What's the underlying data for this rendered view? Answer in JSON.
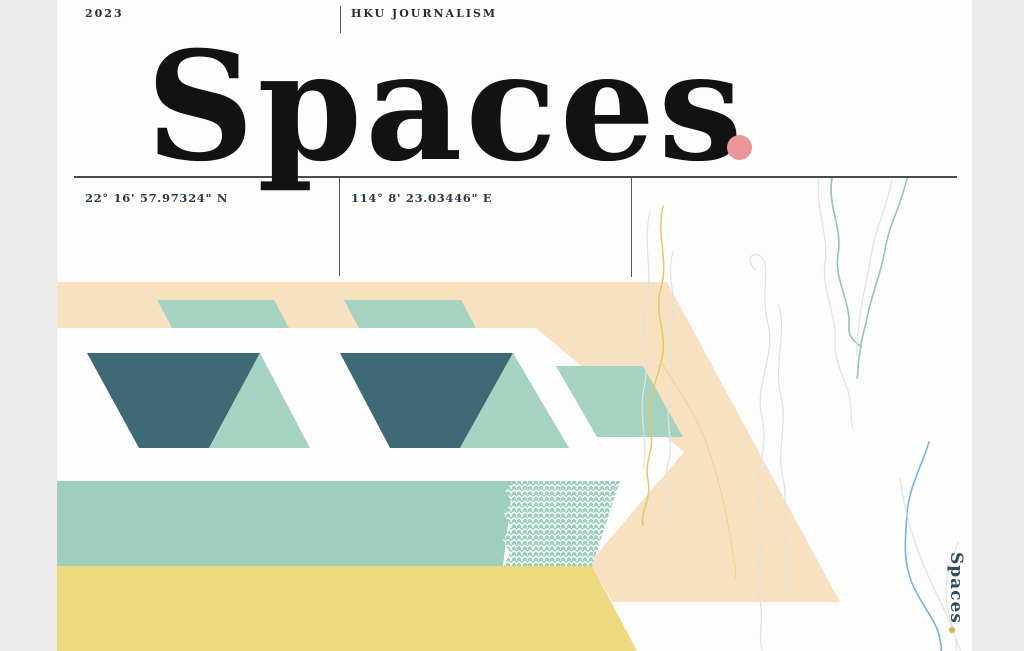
{
  "header": {
    "year": "2023",
    "org": "HKU JOURNALISM"
  },
  "title": {
    "text": "Spaces"
  },
  "coordinates": {
    "latitude": "22° 16' 57.97324\" N",
    "longitude": "114° 8' 23.03446\" E"
  },
  "vertical_label": {
    "text": "Spaces"
  },
  "palette": {
    "page_bg": "#fdfdfd",
    "margin_gray": "#ebebeb",
    "ink": "#121212",
    "header_ink": "#2e2e2e",
    "coord_ink": "#2c3a45",
    "rule": "#4a4a4a",
    "divider": "#555555",
    "cream": "#f8e1c1",
    "mint": "#a6d3c1",
    "mint_band": "#9ecfbe",
    "teal_dark": "#3d6a74",
    "yellow": "#ecda7e",
    "pink": "#ea9598",
    "vert_ink": "#2f4d5a",
    "vert_dot": "#d8b04c",
    "wave_yellow": "#e2c967",
    "wave_pale_yellow": "#ecd795",
    "wave_teal": "#8ec8ad",
    "wave_blue": "#74b3e3",
    "wave_gray": "#e1e1e1",
    "pattern_line": "#ffffff"
  }
}
